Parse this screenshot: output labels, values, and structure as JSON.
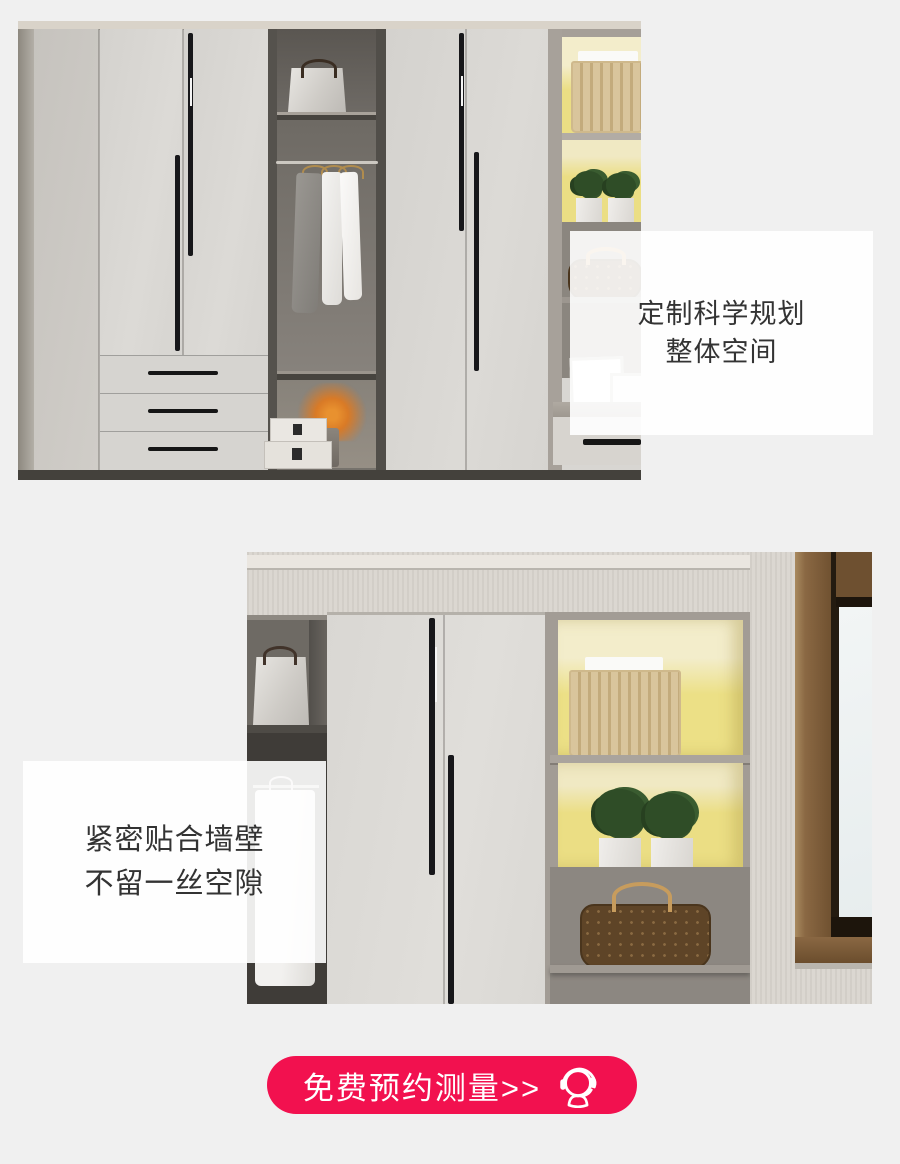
{
  "theme": {
    "page_bg": "#f0f0f0",
    "accent_red": "#f2114f",
    "shelf_yellow": "#ebde84",
    "text_dark": "#333333"
  },
  "feature_boxes": [
    {
      "line1": "定制科学规划",
      "line2": "整体空间"
    },
    {
      "line1": "紧密贴合墙壁",
      "line2": "不留一丝空隙"
    }
  ],
  "cta": {
    "label": "免费预约测量>>",
    "icon": "headset-icon"
  }
}
